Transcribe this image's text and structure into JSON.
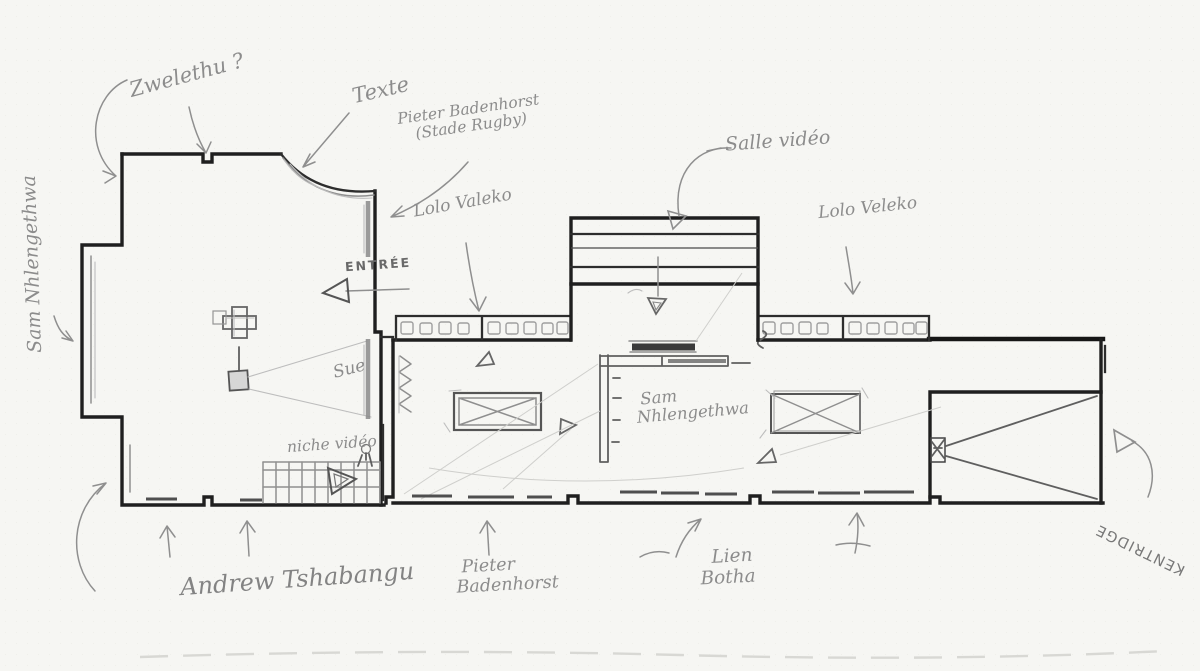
{
  "labels": {
    "zwelethu": "Zwelethu ?",
    "texte": "Texte",
    "pieter_top": {
      "line1": "Pieter Badenhorst",
      "line2": "(Stade Rugby)"
    },
    "lolo_left": "Lolo Valeko",
    "salle_video": "Salle vidéo",
    "lolo_right": "Lolo Veleko",
    "sam_vertical": "Sam Nhlengethwa",
    "entree": "ENTRÉE",
    "sue": "Sue",
    "sam_center": {
      "line1": "Sam",
      "line2": "Nhlengethwa"
    },
    "niche_video": "niche vidéo",
    "andrew": "Andrew Tshabangu",
    "pieter_bottom": {
      "line1": "Pieter",
      "line2": "Badenhorst"
    },
    "lien": {
      "line1": "Lien",
      "line2": "Botha"
    },
    "kentridge": "KENTRIDGE"
  },
  "colors": {
    "paper": "#f6f6f3",
    "ink": "#1f1f1f",
    "pencil": "#8c8c8c"
  }
}
